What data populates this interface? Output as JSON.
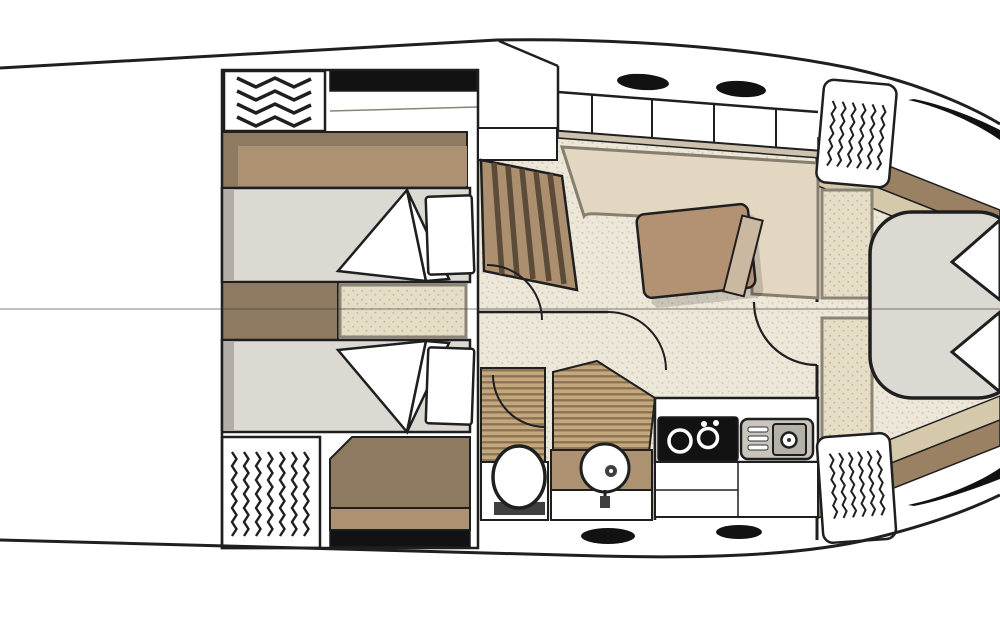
{
  "page": {
    "title": "Yacht interior deck floor plan",
    "view": "overhead plan, bow pointing right",
    "visible_text": "none"
  },
  "colors": {
    "background": "#ffffff",
    "outline": "#1f1f1f",
    "fixture_black": "#121212",
    "floor_base": "#ece7d9",
    "floor_dot": "#d5cdb6",
    "shelf_base": "#e6ddc6",
    "shelf_dot": "#c8bb9c",
    "teak_light": "#c3a87d",
    "teak_dark": "#8a6f50",
    "brown_mid": "#8d7a61",
    "brown_light": "#ac9272",
    "stairs_base": "#ab8f6e",
    "stairs_stripe": "#5d4b3a",
    "bed_gray": "#dcd9d3",
    "bed_shadow": "#b2aea7",
    "pillow_white": "#ffffff",
    "sofa_beige": "#e4d7c2",
    "sofa_edge": "#8a8171",
    "table_wood": "#b29273",
    "door_tan": "#cbb8a0",
    "wall_tan": "#cdc2ae",
    "trim_brown": "#9b8164",
    "trim_tan": "#d5c8ab",
    "counter_gray": "#c9c5bd",
    "basin_gray": "#b4b1a9",
    "hardware_dark": "#3f3f3f",
    "shadow": "rgba(0,0,0,0.15)"
  },
  "rooms": {
    "aft_cabin": "guest cabin with two single berths",
    "head": "bathroom with toilet, round sink and shower",
    "salon": "dinette with L-shaped sofa and wood table",
    "galley": "kitchen with two-burner stove and sink",
    "bow_cabin": "V-berth owner cabin with side shelves"
  },
  "symbols": {
    "zigzag_hatch": "canvas hatch / vent zigzag symbol",
    "deck_hatch_oval": "black oval deck hatch",
    "door_arc": "door swing arc",
    "window_bar": "black side-window bar",
    "centerline": "hull centerline"
  }
}
